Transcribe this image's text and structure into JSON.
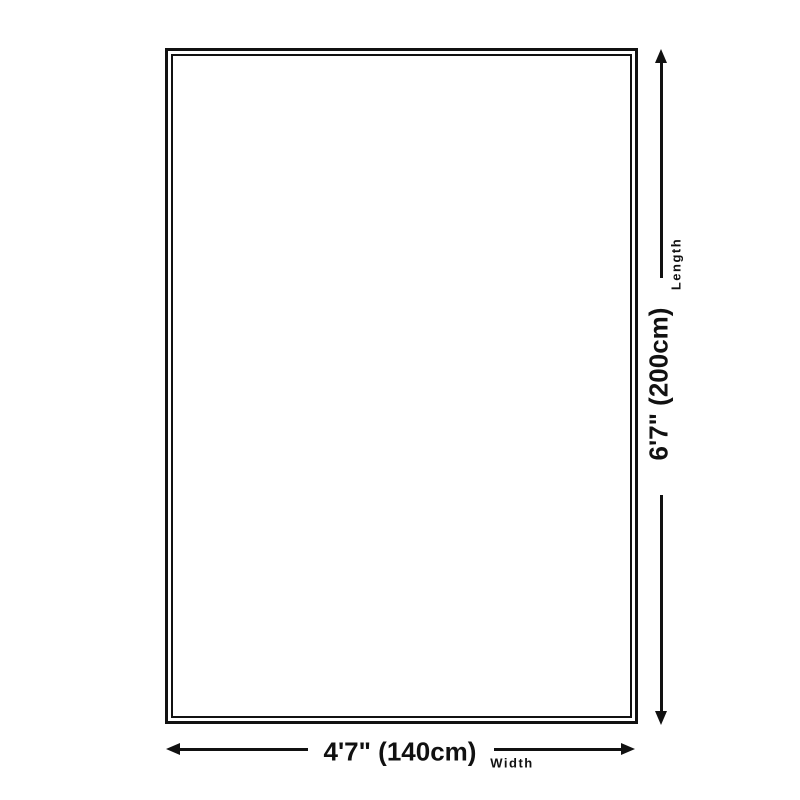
{
  "diagram": {
    "colors": {
      "line": "#111111",
      "background": "#ffffff"
    },
    "length": {
      "value": "6'7\" (200cm)",
      "axis_label": "Length"
    },
    "width": {
      "value": "4'7\" (140cm)",
      "axis_label": "Width"
    }
  }
}
